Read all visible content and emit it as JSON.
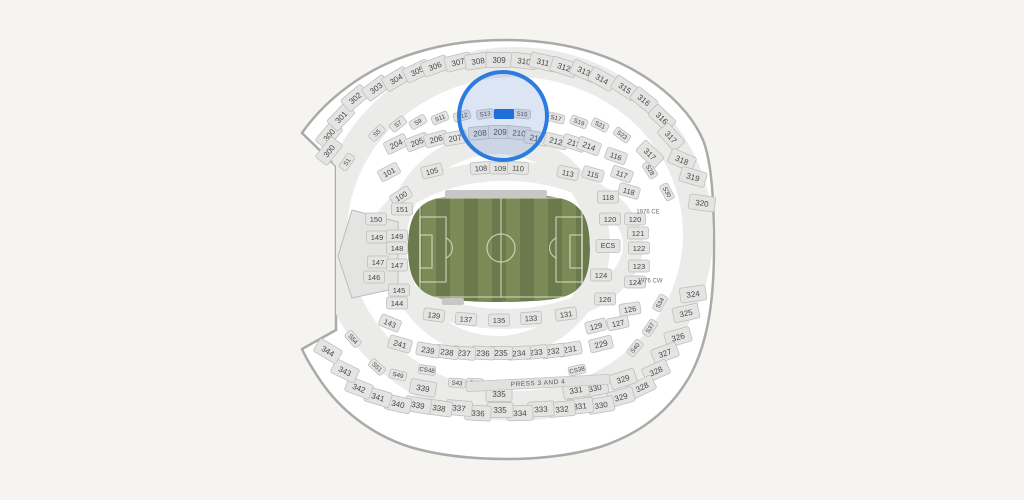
{
  "page": {
    "background": "#f5f4f1"
  },
  "stadium": {
    "outline_color": "#aaaaaa",
    "interior_color": "#ffffff",
    "ring_color": "#ebebea",
    "section_fill": "#e4e4e3",
    "section_stroke": "#bcbcbc",
    "label_color": "#474747",
    "sections": {
      "level_300": [
        {
          "label": "300",
          "x": 329,
          "y": 135,
          "rot": -50
        },
        {
          "label": "300",
          "x": 329,
          "y": 151,
          "rot": -52
        },
        {
          "label": "301",
          "x": 341,
          "y": 117,
          "rot": -46
        },
        {
          "label": "302",
          "x": 355,
          "y": 98,
          "rot": -40
        },
        {
          "label": "303",
          "x": 376,
          "y": 88,
          "rot": -36
        },
        {
          "label": "304",
          "x": 396,
          "y": 79,
          "rot": -31
        },
        {
          "label": "305",
          "x": 417,
          "y": 71,
          "rot": -26
        },
        {
          "label": "306",
          "x": 435,
          "y": 66,
          "rot": -20
        },
        {
          "label": "307",
          "x": 458,
          "y": 62,
          "rot": -14
        },
        {
          "label": "308",
          "x": 478,
          "y": 61,
          "rot": -8
        },
        {
          "label": "309",
          "x": 499,
          "y": 60,
          "rot": 0
        },
        {
          "label": "310",
          "x": 524,
          "y": 61,
          "rot": 7
        },
        {
          "label": "311",
          "x": 543,
          "y": 62,
          "rot": 13
        },
        {
          "label": "312",
          "x": 564,
          "y": 67,
          "rot": 18
        },
        {
          "label": "313",
          "x": 584,
          "y": 71,
          "rot": 24
        },
        {
          "label": "314",
          "x": 602,
          "y": 79,
          "rot": 29
        },
        {
          "label": "315",
          "x": 625,
          "y": 88,
          "rot": 34
        },
        {
          "label": "316",
          "x": 644,
          "y": 100,
          "rot": 39
        },
        {
          "label": "316",
          "x": 662,
          "y": 118,
          "rot": 44
        },
        {
          "label": "317",
          "x": 671,
          "y": 137,
          "rot": 48
        },
        {
          "label": "317",
          "x": 650,
          "y": 154,
          "rot": 44
        },
        {
          "label": "318",
          "x": 682,
          "y": 160,
          "rot": 24
        },
        {
          "label": "319",
          "x": 693,
          "y": 177,
          "rot": 16
        },
        {
          "label": "320",
          "x": 702,
          "y": 203,
          "rot": 8
        },
        {
          "label": "324",
          "x": 693,
          "y": 294,
          "rot": -8
        },
        {
          "label": "325",
          "x": 686,
          "y": 313,
          "rot": -12
        },
        {
          "label": "326",
          "x": 678,
          "y": 337,
          "rot": -16
        },
        {
          "label": "327",
          "x": 665,
          "y": 353,
          "rot": -20
        },
        {
          "label": "328",
          "x": 656,
          "y": 371,
          "rot": -24
        },
        {
          "label": "328",
          "x": 642,
          "y": 387,
          "rot": -26
        },
        {
          "label": "329",
          "x": 623,
          "y": 379,
          "rot": -18
        },
        {
          "label": "329",
          "x": 621,
          "y": 397,
          "rot": -16
        },
        {
          "label": "330",
          "x": 595,
          "y": 388,
          "rot": -12
        },
        {
          "label": "330",
          "x": 601,
          "y": 405,
          "rot": -10
        },
        {
          "label": "331",
          "x": 576,
          "y": 390,
          "rot": -9
        },
        {
          "label": "331",
          "x": 580,
          "y": 406,
          "rot": -7
        },
        {
          "label": "332",
          "x": 562,
          "y": 409,
          "rot": -5
        },
        {
          "label": "333",
          "x": 541,
          "y": 409,
          "rot": -3
        },
        {
          "label": "334",
          "x": 520,
          "y": 413,
          "rot": -1
        },
        {
          "label": "335",
          "x": 499,
          "y": 394,
          "rot": 0
        },
        {
          "label": "335",
          "x": 500,
          "y": 410,
          "rot": 0
        },
        {
          "label": "336",
          "x": 478,
          "y": 413,
          "rot": 3
        },
        {
          "label": "337",
          "x": 459,
          "y": 408,
          "rot": 5
        },
        {
          "label": "338",
          "x": 439,
          "y": 408,
          "rot": 8
        },
        {
          "label": "339",
          "x": 423,
          "y": 388,
          "rot": 10
        },
        {
          "label": "339",
          "x": 418,
          "y": 405,
          "rot": 10
        },
        {
          "label": "340",
          "x": 398,
          "y": 404,
          "rot": 13
        },
        {
          "label": "341",
          "x": 378,
          "y": 397,
          "rot": 17
        },
        {
          "label": "342",
          "x": 359,
          "y": 388,
          "rot": 21
        },
        {
          "label": "343",
          "x": 345,
          "y": 371,
          "rot": 26
        },
        {
          "label": "344",
          "x": 328,
          "y": 351,
          "rot": 31
        }
      ],
      "level_200": [
        {
          "label": "204",
          "x": 396,
          "y": 144,
          "rot": -26
        },
        {
          "label": "205",
          "x": 417,
          "y": 142,
          "rot": -21
        },
        {
          "label": "206",
          "x": 436,
          "y": 139,
          "rot": -15
        },
        {
          "label": "207",
          "x": 455,
          "y": 138,
          "rot": -10
        },
        {
          "label": "208",
          "x": 480,
          "y": 133,
          "rot": -5
        },
        {
          "label": "209",
          "x": 500,
          "y": 132,
          "rot": 0
        },
        {
          "label": "210",
          "x": 519,
          "y": 133,
          "rot": 5
        },
        {
          "label": "211",
          "x": 536,
          "y": 138,
          "rot": 10
        },
        {
          "label": "212",
          "x": 556,
          "y": 141,
          "rot": 14
        },
        {
          "label": "213",
          "x": 574,
          "y": 143,
          "rot": 18
        },
        {
          "label": "214",
          "x": 589,
          "y": 146,
          "rot": 21
        },
        {
          "label": "229",
          "x": 601,
          "y": 344,
          "rot": -14
        },
        {
          "label": "231",
          "x": 570,
          "y": 349,
          "rot": -10
        },
        {
          "label": "232",
          "x": 553,
          "y": 351,
          "rot": -8
        },
        {
          "label": "233",
          "x": 536,
          "y": 352,
          "rot": -6
        },
        {
          "label": "234",
          "x": 519,
          "y": 353,
          "rot": -4
        },
        {
          "label": "235",
          "x": 501,
          "y": 353,
          "rot": 0
        },
        {
          "label": "236",
          "x": 483,
          "y": 353,
          "rot": 3
        },
        {
          "label": "237",
          "x": 464,
          "y": 353,
          "rot": 5
        },
        {
          "label": "238",
          "x": 447,
          "y": 352,
          "rot": 7
        },
        {
          "label": "239",
          "x": 428,
          "y": 350,
          "rot": 10
        },
        {
          "label": "241",
          "x": 400,
          "y": 344,
          "rot": 16
        }
      ],
      "level_100": [
        {
          "label": "101",
          "x": 389,
          "y": 172,
          "rot": -28
        },
        {
          "label": "105",
          "x": 432,
          "y": 171,
          "rot": -14
        },
        {
          "label": "108",
          "x": 481,
          "y": 168,
          "rot": -4
        },
        {
          "label": "109",
          "x": 500,
          "y": 168,
          "rot": 0
        },
        {
          "label": "110",
          "x": 518,
          "y": 168,
          "rot": 4
        },
        {
          "label": "113",
          "x": 568,
          "y": 173,
          "rot": 12
        },
        {
          "label": "115",
          "x": 593,
          "y": 174,
          "rot": 16
        },
        {
          "label": "116",
          "x": 616,
          "y": 156,
          "rot": 20
        },
        {
          "label": "117",
          "x": 622,
          "y": 174,
          "rot": 20
        },
        {
          "label": "118",
          "x": 629,
          "y": 191,
          "rot": 16
        },
        {
          "label": "118",
          "x": 608,
          "y": 197,
          "rot": 0
        },
        {
          "label": "120",
          "x": 610,
          "y": 219,
          "rot": 0
        },
        {
          "label": "120",
          "x": 635,
          "y": 219,
          "rot": 0
        },
        {
          "label": "121",
          "x": 638,
          "y": 233,
          "rot": 0
        },
        {
          "label": "122",
          "x": 639,
          "y": 248,
          "rot": 0
        },
        {
          "label": "123",
          "x": 639,
          "y": 266,
          "rot": 0
        },
        {
          "label": "124",
          "x": 601,
          "y": 275,
          "rot": 0
        },
        {
          "label": "124",
          "x": 635,
          "y": 282,
          "rot": 0
        },
        {
          "label": "126",
          "x": 605,
          "y": 299,
          "rot": 0
        },
        {
          "label": "126",
          "x": 630,
          "y": 309,
          "rot": -8
        },
        {
          "label": "127",
          "x": 618,
          "y": 323,
          "rot": -12
        },
        {
          "label": "129",
          "x": 596,
          "y": 326,
          "rot": -14
        },
        {
          "label": "131",
          "x": 566,
          "y": 314,
          "rot": -8
        },
        {
          "label": "133",
          "x": 531,
          "y": 318,
          "rot": -4
        },
        {
          "label": "135",
          "x": 499,
          "y": 320,
          "rot": 0
        },
        {
          "label": "137",
          "x": 466,
          "y": 319,
          "rot": 4
        },
        {
          "label": "139",
          "x": 434,
          "y": 315,
          "rot": 8
        },
        {
          "label": "100",
          "x": 401,
          "y": 196,
          "rot": -32
        },
        {
          "label": "151",
          "x": 402,
          "y": 209,
          "rot": 0
        },
        {
          "label": "150",
          "x": 376,
          "y": 219,
          "rot": 0
        },
        {
          "label": "149",
          "x": 377,
          "y": 237,
          "rot": 0
        },
        {
          "label": "149",
          "x": 397,
          "y": 236,
          "rot": 0
        },
        {
          "label": "148",
          "x": 397,
          "y": 248,
          "rot": 0
        },
        {
          "label": "147",
          "x": 378,
          "y": 262,
          "rot": 0
        },
        {
          "label": "147",
          "x": 397,
          "y": 265,
          "rot": 0
        },
        {
          "label": "146",
          "x": 374,
          "y": 277,
          "rot": 0
        },
        {
          "label": "145",
          "x": 399,
          "y": 290,
          "rot": 0
        },
        {
          "label": "144",
          "x": 397,
          "y": 303,
          "rot": 0
        },
        {
          "label": "143",
          "x": 390,
          "y": 323,
          "rot": 22
        }
      ],
      "suites": [
        {
          "label": "S1",
          "x": 347,
          "y": 162,
          "rot": -55
        },
        {
          "label": "S5",
          "x": 377,
          "y": 133,
          "rot": -46
        },
        {
          "label": "S7",
          "x": 398,
          "y": 124,
          "rot": -38
        },
        {
          "label": "S9",
          "x": 418,
          "y": 122,
          "rot": -30
        },
        {
          "label": "S11",
          "x": 440,
          "y": 118,
          "rot": -22
        },
        {
          "label": "S12",
          "x": 462,
          "y": 116,
          "rot": -15
        },
        {
          "label": "S13",
          "x": 485,
          "y": 114,
          "rot": -8
        },
        {
          "label": "S15",
          "x": 522,
          "y": 114,
          "rot": 5
        },
        {
          "label": "S17",
          "x": 556,
          "y": 118,
          "rot": 14
        },
        {
          "label": "S19",
          "x": 579,
          "y": 122,
          "rot": 21
        },
        {
          "label": "S21",
          "x": 600,
          "y": 125,
          "rot": 27
        },
        {
          "label": "S23",
          "x": 622,
          "y": 135,
          "rot": 36
        },
        {
          "label": "S28",
          "x": 650,
          "y": 170,
          "rot": 58
        },
        {
          "label": "S30",
          "x": 667,
          "y": 192,
          "rot": 62
        },
        {
          "label": "S34",
          "x": 660,
          "y": 303,
          "rot": -60
        },
        {
          "label": "S37",
          "x": 650,
          "y": 328,
          "rot": -56
        },
        {
          "label": "S40",
          "x": 635,
          "y": 348,
          "rot": -50
        },
        {
          "label": "S54",
          "x": 353,
          "y": 339,
          "rot": 48
        },
        {
          "label": "S51",
          "x": 377,
          "y": 367,
          "rot": 42
        },
        {
          "label": "S49",
          "x": 398,
          "y": 375,
          "rot": 14
        },
        {
          "label": "CS48",
          "x": 427,
          "y": 370,
          "rot": 8
        },
        {
          "label": "S43",
          "x": 457,
          "y": 383,
          "rot": 5
        },
        {
          "label": "S41",
          "x": 475,
          "y": 383,
          "rot": 3
        },
        {
          "label": "CS38",
          "x": 577,
          "y": 370,
          "rot": -12
        }
      ],
      "clubs": [
        {
          "label": "ECS",
          "x": 608,
          "y": 246,
          "rot": 0,
          "chip": true
        },
        {
          "label": "1976 CE",
          "x": 648,
          "y": 212,
          "rot": 0,
          "chip": false
        },
        {
          "label": "1976 CW",
          "x": 650,
          "y": 281,
          "rot": 0,
          "chip": false
        }
      ],
      "press": {
        "label": "PRESS 3 AND 4",
        "x": 538,
        "y": 383,
        "rot": -3
      }
    },
    "selected_suite": {
      "x": 504,
      "y": 114,
      "width": 20,
      "height": 10,
      "color": "#1f6fd9"
    },
    "highlight_circle": {
      "cx": 503,
      "cy": 116,
      "r": 44,
      "stroke": "#2e7bdf",
      "stroke_width": 4,
      "fill": "rgba(90,135,205,0.22)"
    }
  },
  "field": {
    "type": "soccer-pitch",
    "stripe_dark": "#6a7a4c",
    "stripe_light": "#7b8b57",
    "line_color": "rgba(225,232,205,0.75)",
    "tunnel_bar_color": "#c7c7c7"
  }
}
